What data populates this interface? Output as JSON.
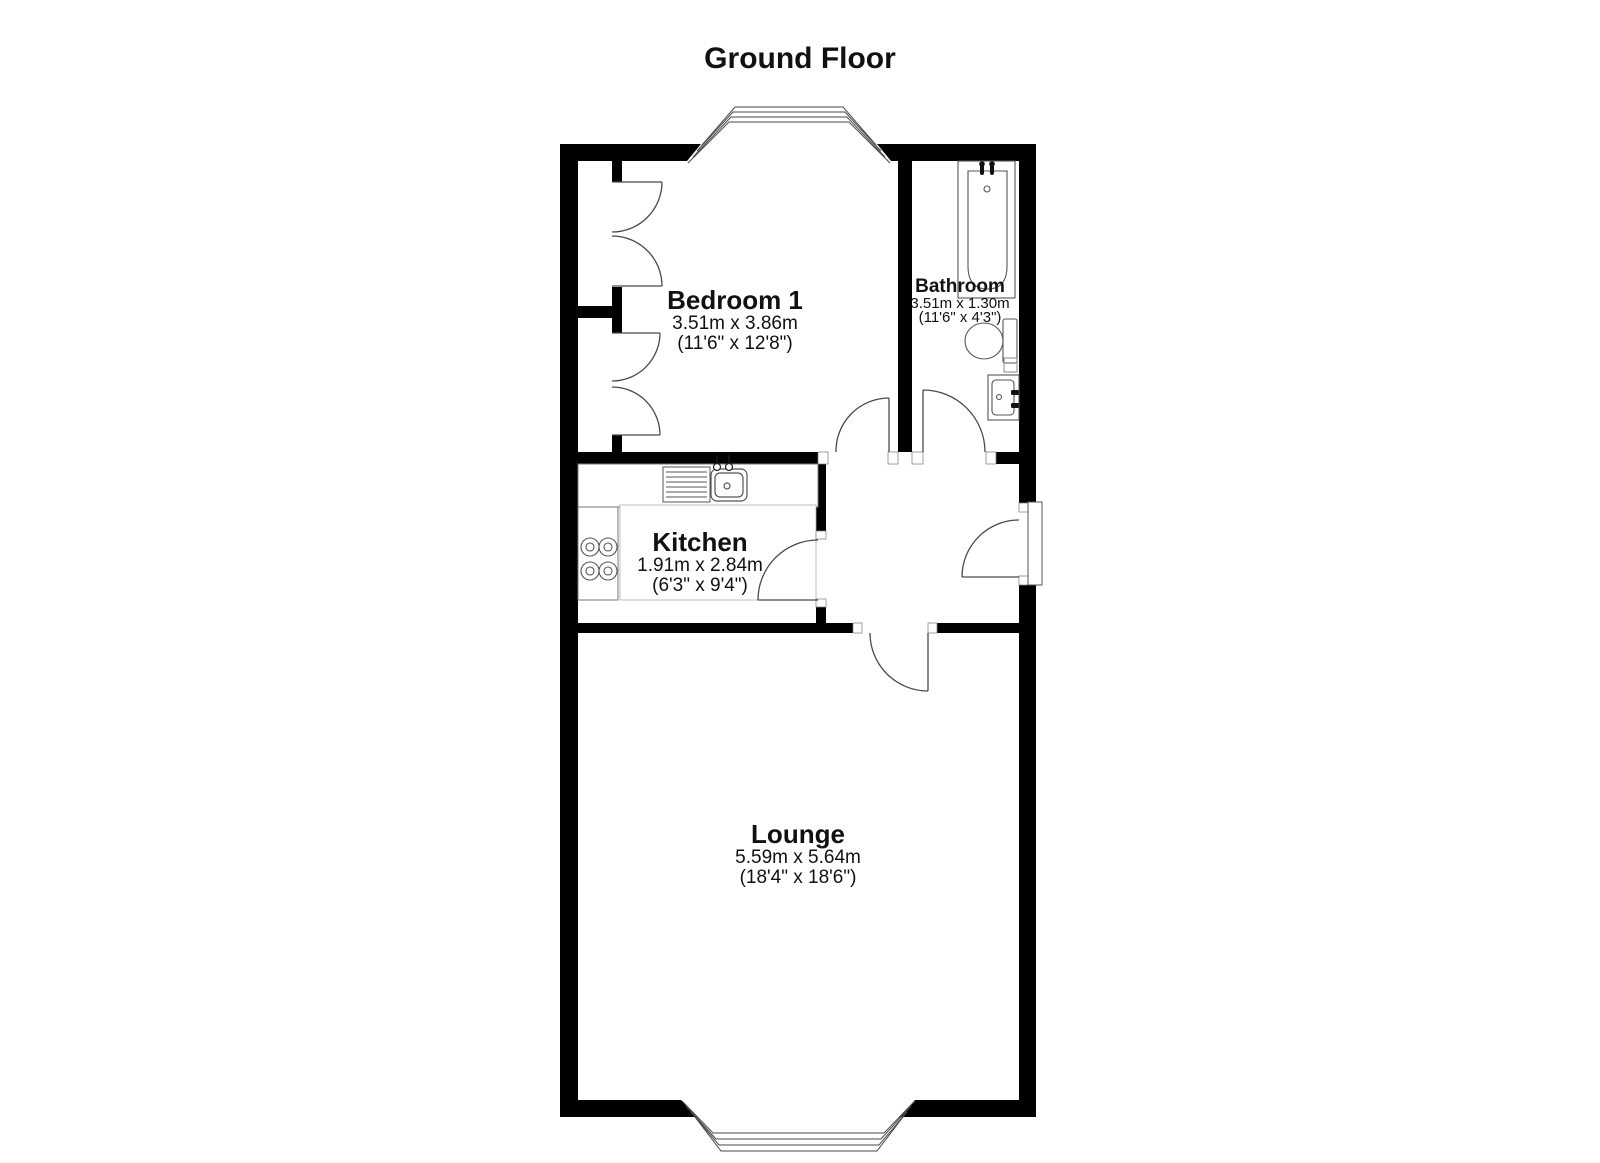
{
  "title": "Ground Floor",
  "rooms": {
    "bedroom1": {
      "name": "Bedroom 1",
      "metric": "3.51m x 3.86m",
      "imperial": "(11'6\" x 12'8\")"
    },
    "bathroom": {
      "name": "Bathroom",
      "metric": "3.51m x 1.30m",
      "imperial": "(11'6\" x 4'3\")"
    },
    "kitchen": {
      "name": "Kitchen",
      "metric": "1.91m x 2.84m",
      "imperial": "(6'3\" x 9'4\")"
    },
    "lounge": {
      "name": "Lounge",
      "metric": "5.59m x 5.64m",
      "imperial": "(18'4\" x 18'6\")"
    }
  },
  "fixtures": [
    "bathtub",
    "toilet",
    "basin",
    "kitchen-sink",
    "drainer",
    "hob",
    "bay-window-top",
    "bay-window-bottom",
    "wardrobe-doors",
    "entrance-door"
  ],
  "colors": {
    "wall": "#000000",
    "line": "#4a4a4a",
    "background": "#ffffff",
    "text": "#111111"
  }
}
